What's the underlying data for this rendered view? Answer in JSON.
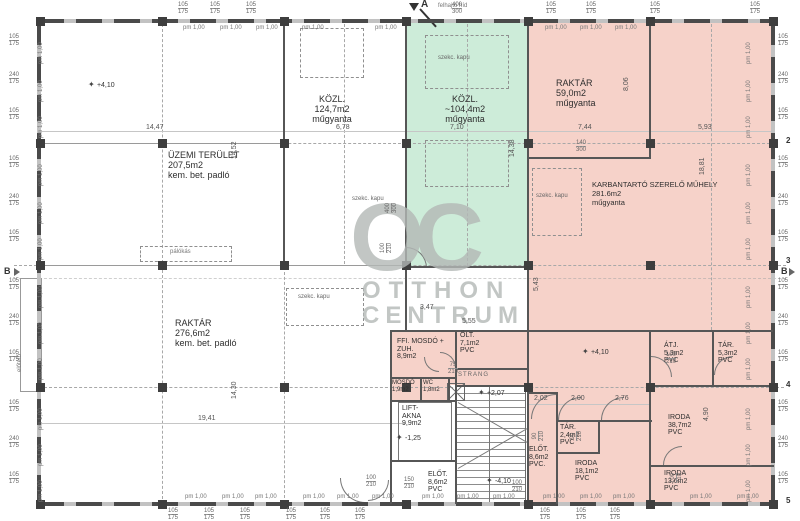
{
  "watermark": {
    "logo": "OC",
    "line1": "OTTHON",
    "line2": "CENTRUM"
  },
  "labels": {
    "szekc_kapu": "szekc. kapu",
    "pm": "pm 1,00",
    "strang": "STRANG",
    "felhajto": "felhajtó híd",
    "palokas": "pálókás",
    "eloteto": "előtető",
    "elev_symbol": "✦"
  },
  "grid": {
    "section_a": "A",
    "b_left": "B",
    "b_right": "B",
    "right_rows": [
      "2",
      "3",
      "4",
      "5"
    ]
  },
  "rooms": {
    "uzemi": {
      "name": "ÜZEMI TERÜLET",
      "area": "207,5m2",
      "floor": "kem. bet. padló"
    },
    "kozl1": {
      "name": "KÖZL.",
      "area": "124,7m2",
      "floor": "műgyanta"
    },
    "kozl2": {
      "name": "KÖZL.",
      "area": "~104,4m2",
      "floor": "műgyanta"
    },
    "raktar59": {
      "name": "RAKTÁR",
      "area": "59,0m2",
      "floor": "műgyanta"
    },
    "muhely": {
      "name": "KARBANTARTÓ SZERELŐ MŰHELY",
      "area": "281.6m2",
      "floor": "műgyanta"
    },
    "raktar276": {
      "name": "RAKTÁR",
      "area": "276,6m2",
      "floor": "kem. bet. padló"
    },
    "ffi": {
      "name": "FFI. MOSDÓ + ZUH.",
      "area": "8,9m2",
      "floor": ""
    },
    "olt": {
      "name": "ÖLT.",
      "area": "7,1m2",
      "floor": "PVC"
    },
    "mosdo": {
      "name": "MOSDÓ",
      "area": "1,9m2",
      "floor": ""
    },
    "wc": {
      "name": "WC",
      "area": "1,8m2",
      "floor": ""
    },
    "lift": {
      "name": "LIFT- AKNA",
      "area": "9,9m2",
      "floor": ""
    },
    "elot1": {
      "name": "ELŐT.",
      "area": "8,6m2",
      "floor": "PVC"
    },
    "elot2": {
      "name": "ELŐT.",
      "area": "8,6m2",
      "floor": "PVC."
    },
    "tar24": {
      "name": "TÁR.",
      "area": "2,4m2",
      "floor": "PVC"
    },
    "iroda181": {
      "name": "IRODA",
      "area": "18,1m2",
      "floor": "PVC"
    },
    "iroda387": {
      "name": "IRODA",
      "area": "38,7m2",
      "floor": "PVC"
    },
    "iroda136": {
      "name": "IRODA",
      "area": "13,6m2",
      "floor": "PVC"
    },
    "atj": {
      "name": "ÁTJ.",
      "area": "5,3m2",
      "floor": "PVC"
    },
    "tar53": {
      "name": "TÁR.",
      "area": "5,3m2",
      "floor": "PVC"
    }
  },
  "gen": {
    "gates": [
      [
        438,
        55
      ],
      [
        352,
        196
      ],
      [
        536,
        193
      ],
      [
        298,
        294
      ]
    ],
    "pm_top": [
      [
        183,
        25
      ],
      [
        220,
        25
      ],
      [
        256,
        25
      ],
      [
        302,
        25
      ],
      [
        375,
        25
      ],
      [
        545,
        25
      ],
      [
        580,
        25
      ],
      [
        615,
        25
      ]
    ],
    "pm_bottom": [
      [
        185,
        494
      ],
      [
        222,
        494
      ],
      [
        255,
        494
      ],
      [
        303,
        494
      ],
      [
        337,
        494
      ],
      [
        372,
        494
      ],
      [
        422,
        494
      ],
      [
        457,
        494
      ],
      [
        493,
        494
      ],
      [
        543,
        494
      ],
      [
        580,
        494
      ],
      [
        613,
        494
      ],
      [
        690,
        494
      ],
      [
        737,
        494
      ]
    ],
    "pm_left": [
      [
        44,
        58
      ],
      [
        44,
        96
      ],
      [
        44,
        132
      ],
      [
        44,
        180
      ],
      [
        44,
        218
      ],
      [
        44,
        254
      ],
      [
        44,
        302
      ],
      [
        44,
        338
      ],
      [
        44,
        374
      ],
      [
        44,
        424
      ],
      [
        44,
        460
      ],
      [
        44,
        496
      ]
    ],
    "pm_right": [
      [
        752,
        58
      ],
      [
        752,
        96
      ],
      [
        752,
        132
      ],
      [
        752,
        180
      ],
      [
        752,
        218
      ],
      [
        752,
        254
      ],
      [
        752,
        302
      ],
      [
        752,
        338
      ],
      [
        752,
        374
      ],
      [
        752,
        424
      ],
      [
        752,
        460
      ],
      [
        752,
        496
      ]
    ],
    "win_pairs": [
      [
        9,
        34,
        "105",
        "175"
      ],
      [
        9,
        72,
        "240",
        "175"
      ],
      [
        9,
        108,
        "105",
        "175"
      ],
      [
        9,
        156,
        "105",
        "175"
      ],
      [
        9,
        194,
        "240",
        "175"
      ],
      [
        9,
        230,
        "105",
        "175"
      ],
      [
        9,
        278,
        "105",
        "175"
      ],
      [
        9,
        314,
        "240",
        "175"
      ],
      [
        9,
        350,
        "105",
        "175"
      ],
      [
        9,
        400,
        "105",
        "175"
      ],
      [
        9,
        436,
        "240",
        "175"
      ],
      [
        9,
        472,
        "105",
        "175"
      ],
      [
        778,
        34,
        "105",
        "175"
      ],
      [
        778,
        72,
        "240",
        "175"
      ],
      [
        778,
        108,
        "105",
        "175"
      ],
      [
        778,
        156,
        "105",
        "175"
      ],
      [
        778,
        194,
        "240",
        "175"
      ],
      [
        778,
        230,
        "105",
        "175"
      ],
      [
        778,
        278,
        "105",
        "175"
      ],
      [
        778,
        314,
        "240",
        "175"
      ],
      [
        778,
        350,
        "105",
        "175"
      ],
      [
        778,
        400,
        "105",
        "175"
      ],
      [
        778,
        436,
        "240",
        "175"
      ],
      [
        778,
        472,
        "105",
        "175"
      ],
      [
        178,
        2,
        "105",
        "175"
      ],
      [
        210,
        2,
        "105",
        "175"
      ],
      [
        246,
        2,
        "105",
        "175"
      ],
      [
        546,
        2,
        "105",
        "175"
      ],
      [
        586,
        2,
        "105",
        "175"
      ],
      [
        650,
        2,
        "105",
        "175"
      ],
      [
        750,
        2,
        "105",
        "175"
      ],
      [
        452,
        2,
        "400",
        "300"
      ],
      [
        168,
        508,
        "105",
        "175"
      ],
      [
        204,
        508,
        "105",
        "175"
      ],
      [
        240,
        508,
        "105",
        "175"
      ],
      [
        286,
        508,
        "105",
        "175"
      ],
      [
        320,
        508,
        "105",
        "175"
      ],
      [
        355,
        508,
        "105",
        "175"
      ],
      [
        540,
        508,
        "105",
        "175"
      ],
      [
        576,
        508,
        "105",
        "175"
      ],
      [
        610,
        508,
        "105",
        "175"
      ]
    ],
    "door_pairs": [
      [
        393,
        240,
        "100",
        "210",
        1
      ],
      [
        404,
        477,
        "150",
        "210",
        0
      ],
      [
        366,
        475,
        "100",
        "210",
        0
      ],
      [
        512,
        480,
        "100",
        "210",
        0
      ],
      [
        448,
        362,
        "75",
        "210",
        0
      ],
      [
        666,
        352,
        "100",
        "210",
        0
      ],
      [
        545,
        428,
        "90",
        "210",
        1
      ],
      [
        583,
        428,
        "90",
        "210",
        1
      ],
      [
        683,
        470,
        "100",
        "210",
        1
      ],
      [
        576,
        140,
        "140",
        "300",
        0
      ],
      [
        398,
        200,
        "400",
        "300",
        1
      ]
    ],
    "dims_h": [
      [
        146,
        124,
        "14,47"
      ],
      [
        336,
        124,
        "6,78"
      ],
      [
        450,
        124,
        "7,10"
      ],
      [
        578,
        124,
        "7,44"
      ],
      [
        698,
        124,
        "5,93"
      ],
      [
        198,
        415,
        "19,41"
      ],
      [
        534,
        395,
        "2,02"
      ],
      [
        571,
        395,
        "2,00"
      ],
      [
        615,
        395,
        "2,76"
      ],
      [
        462,
        318,
        "5,55"
      ],
      [
        420,
        304,
        "3,47"
      ]
    ],
    "dims_v": [
      [
        238,
        152,
        "14,52"
      ],
      [
        238,
        392,
        "14,30"
      ],
      [
        516,
        150,
        "14,38"
      ],
      [
        706,
        168,
        "18,81"
      ],
      [
        630,
        84,
        "8,06"
      ],
      [
        540,
        284,
        "5,43"
      ],
      [
        710,
        414,
        "4,90"
      ]
    ],
    "elev": [
      [
        88,
        80,
        "+4,10"
      ],
      [
        582,
        347,
        "+4,10"
      ],
      [
        486,
        476,
        "-4,10"
      ],
      [
        478,
        388,
        "+2,07"
      ],
      [
        396,
        433,
        "-1,25"
      ]
    ],
    "cols": {
      "xs": [
        40,
        162,
        284,
        406,
        528,
        650,
        773
      ],
      "ys": [
        21,
        143,
        265,
        387,
        504
      ]
    }
  },
  "colors": {
    "pink": "#f6d2c9",
    "green": "#cdecd9",
    "wall": "#565656",
    "watermark": "#b3b8b6"
  }
}
